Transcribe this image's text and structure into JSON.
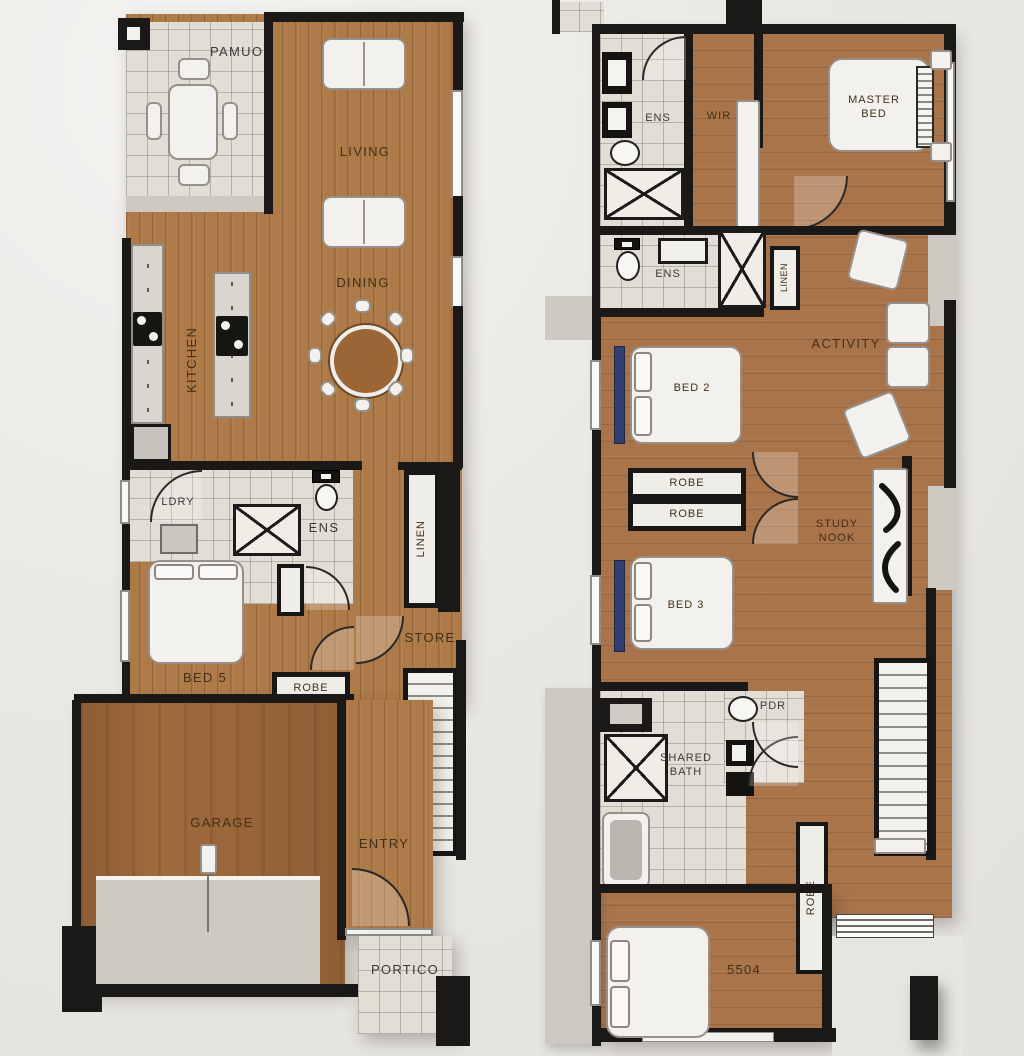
{
  "meta": {
    "type": "residential floor plan, two storeys side by side"
  },
  "colors": {
    "background": "#e9e7e3",
    "wood": "#ae7a47",
    "garage_wood": "#a06a3c",
    "tile": "#e2ded6",
    "wall": "#1a1918",
    "concrete": "#cdc9c2",
    "furniture": "#f3f1ed",
    "accent_blue": "#31406e",
    "label_text": "#432f18"
  },
  "ground_floor": {
    "labels": {
      "pavilion": "PAMUON",
      "living": "LIVING",
      "dining": "DINING",
      "kitchen": "KITCHEN",
      "laundry": "LDRY",
      "ensuite": "ENS",
      "linen": "LINEN",
      "bed5": "BED 5",
      "robe": "ROBE",
      "store": "STORE",
      "garage": "GARAGE",
      "entry": "ENTRY",
      "portico": "PORTICO"
    }
  },
  "first_floor": {
    "labels": {
      "ensuite_top": "ENS",
      "wir": "WIR",
      "master_bed": "MASTER BED",
      "ensuite_mid": "ENS",
      "linen": "LINEN",
      "activity": "ACTIVITY",
      "bed2": "BED 2",
      "robe_upper": "ROBE",
      "robe_lower": "ROBE",
      "study_nook": "STUDY NOOK",
      "bed3": "BED 3",
      "shared_bath": "SHARED BATH",
      "powder": "PDR",
      "robe_vertical": "ROBE",
      "bed4_code": "5504"
    }
  }
}
